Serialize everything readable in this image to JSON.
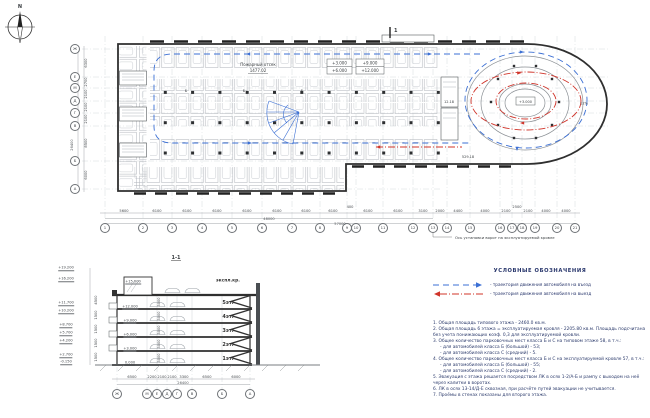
{
  "compass": {
    "label": "N"
  },
  "plan": {
    "fire_compartment_label": "Пожарный отсек",
    "fire_compartment_area": "1477.02",
    "levels_box1_line1": "+3.000",
    "levels_box1_line2": "+6.000",
    "levels_box2_line1": "+9.000",
    "levels_box2_line2": "+12.000",
    "ramp_center_level": "+3.000",
    "ramp_slope": "12%",
    "room_area_small": "12.18",
    "room_area_large": "529.18",
    "stall_class_label": "Б",
    "section_mark": "1",
    "gate_axis_note": "Ось установки ворот на эксплуатируемой кровле",
    "axes_bottom": [
      "1",
      "2",
      "3",
      "4",
      "5",
      "6",
      "7",
      "8",
      "9",
      "10",
      "11",
      "12",
      "13",
      "14",
      "15",
      "16",
      "17",
      "18",
      "19",
      "20",
      "21"
    ],
    "dims_bottom": [
      "5600",
      "6100",
      "6100",
      "6100",
      "6100",
      "6100",
      "6100",
      "6100",
      "400",
      "6100",
      "6100",
      "3100",
      "2000",
      "4400",
      "4000",
      "2100",
      "2500",
      "2100",
      "4000",
      "4000"
    ],
    "dims_subtotal": "48000",
    "dims_total": "57000",
    "axes_left": [
      "Ж",
      "Е",
      "М",
      "Д",
      "Г",
      "В",
      "Б",
      "А"
    ],
    "dims_left": [
      "6300",
      "2700",
      "2100",
      "2100",
      "2100",
      "8500",
      "6000"
    ],
    "dims_left_total": "26400"
  },
  "section": {
    "title": "1-1",
    "floors": [
      "экспл.кр.",
      "5эт.",
      "4эт.",
      "3эт.",
      "2эт.",
      "1эт."
    ],
    "levels_inner": [
      "+15.000",
      "+12.000",
      "+9.000",
      "+6.000",
      "+3.000",
      "0.000"
    ],
    "levels_left": [
      "+19.200",
      "+16.200",
      "+11.700",
      "+10.200",
      "+8.700",
      "+5.700",
      "+4.200",
      "+2.700",
      "-0.150"
    ],
    "dims_vertical_inner": [
      "3000",
      "3000",
      "3000",
      "3000",
      "3000"
    ],
    "dims_left_vertical": [
      "4500",
      "1500",
      "1500",
      "1500",
      "1500"
    ],
    "dims_bottom": [
      "6500",
      "2200",
      "2100",
      "2100",
      "3300",
      "6500",
      "6000"
    ],
    "dims_total": "26400",
    "axes": [
      "Ж",
      "М",
      "Е",
      "Д",
      "Г",
      "В",
      "Б",
      "А"
    ]
  },
  "legend": {
    "title": "УСЛОВНЫЕ ОБОЗНАЧЕНИЯ",
    "entry_label": "- траектория движения автомобиля на въезд",
    "exit_label": "- траектория движения автомобиля на выезд",
    "entry_color": "#3b6fd4",
    "exit_color": "#d0342a"
  },
  "notes": {
    "items": [
      "1. Общая площадь типового этажа - 2460.0 кв.м.",
      "2. Общая площадь 6 этажа = эксплуатируемая кровля - 2205.80 кв.м. Площадь подсчитана без учета понижающих коэф. 0,3 для эксплуатируемой кровли.",
      "3. Общее количество парковочных мест класса Б и С на типовом этаже 58, в т.ч.:",
      "- для автомобилей класса Б (большой) - 53;",
      "- для автомобилей класса С (средний) - 5.",
      "4. Общее количество парковочных мест класса Б и С на эксплуатируемой кровле 57, в т.ч.:",
      "- для автомобилей класса Б (большой) - 55;",
      "- для автомобилей класса С (средний) - 2.",
      "5. Эвакуация с этажа решается посредством ЛК в осях 1-2/А-Б и рампу с выходом на неё через калитки в воротах.",
      "6. ЛК в осях 13-14/Д-Е сквозная, при расчёте путей эвакуации не учитывается.",
      "7. Проёмы в стенах показаны для второго этажа."
    ]
  }
}
